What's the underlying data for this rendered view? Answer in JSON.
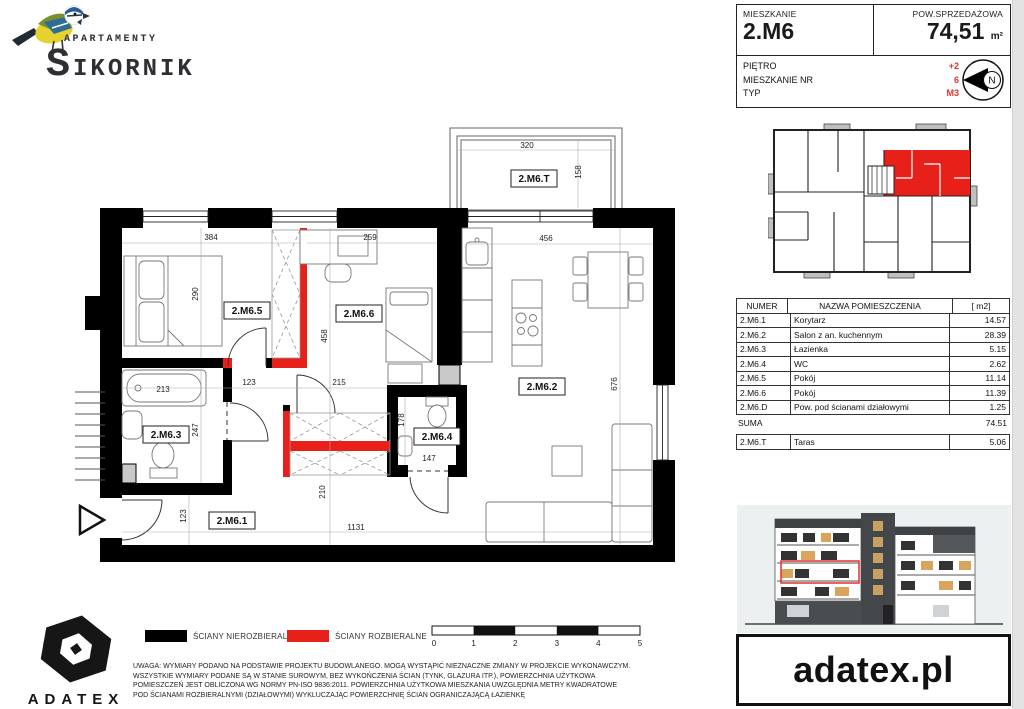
{
  "brand": {
    "apartamenty": "APARTAMENTY",
    "sikornik": "SIKORNIK",
    "adatex": "ADATEX",
    "website": "adatex.pl"
  },
  "info": {
    "mieszkanie_label": "MIESZKANIE",
    "mieszkanie_value": "2.M6",
    "pow_label": "POW.SPRZEDAŻOWA",
    "pow_value": "74,51",
    "pow_unit": "m²",
    "rows": [
      {
        "label": "PIĘTRO",
        "value": "+2"
      },
      {
        "label": "MIESZKANIE NR",
        "value": "6"
      },
      {
        "label": "TYP",
        "value": "M3"
      }
    ],
    "compass_n": "N",
    "accent_color": "#e03030"
  },
  "rooms_table": {
    "headers": [
      "NUMER",
      "NAZWA POMIESZCZENIA",
      "[ m2]"
    ],
    "rows": [
      {
        "num": "2.M6.1",
        "name": "Korytarz",
        "area": "14.57"
      },
      {
        "num": "2.M6.2",
        "name": "Salon z an. kuchennym",
        "area": "28.39"
      },
      {
        "num": "2.M6.3",
        "name": "Łazienka",
        "area": "5.15"
      },
      {
        "num": "2.M6.4",
        "name": "WC",
        "area": "2.62"
      },
      {
        "num": "2.M6.5",
        "name": "Pokój",
        "area": "11.14"
      },
      {
        "num": "2.M6.6",
        "name": "Pokój",
        "area": "11.39"
      },
      {
        "num": "2.M6.D",
        "name": "Pow. pod ścianami działowymi",
        "area": "1.25"
      }
    ],
    "suma_label": "SUMA",
    "suma_value": "74.51",
    "taras": {
      "num": "2.M6.T",
      "name": "Taras",
      "area": "5.06"
    }
  },
  "plan": {
    "labels": {
      "r1": "2.M6.1",
      "r2": "2.M6.2",
      "r3": "2.M6.3",
      "r4": "2.M6.4",
      "r5": "2.M6.5",
      "r6": "2.M6.6",
      "t": "2.M6.T"
    },
    "dims": {
      "terrace_w": "320",
      "terrace_h": "158",
      "w384": "384",
      "h290": "290",
      "w259": "259",
      "h458": "458",
      "w456": "456",
      "h676": "676",
      "tub213": "213",
      "w123": "123",
      "w215": "215",
      "h247": "247",
      "h178": "178",
      "w147": "147",
      "e123": "123",
      "h210": "210",
      "w1131": "1131"
    },
    "wall_black": "#000000",
    "wall_red": "#e8201a"
  },
  "legend": {
    "item1": "ŚCIANY NIEROZBIERALNE",
    "item2": "ŚCIANY ROZBIERALNE",
    "wall_black": "#000000",
    "wall_red": "#e8201a",
    "scale_ticks": [
      "0",
      "1",
      "2",
      "3",
      "4",
      "5"
    ]
  },
  "disclaimer": {
    "line1": "UWAGA:  WYMIARY PODANO NA PODSTAWIE PROJEKTU BUDOWLANEGO.  MOGĄ WYSTĄPIĆ NIEZNACZNE ZMIANY W PROJEKCIE WYKONAWCZYM.",
    "line2": "WSZYSTKIE WYMIARY PODANE SĄ W STANIE SUROWYM, BEZ WYKOŃCZENIA ŚCIAN (TYNK, GLAZURA ITP.), POWIERZCHNIA UŻYTKOWA",
    "line3": "POMIESZCZEŃ JEST OBLICZONA WG NORMY PN-ISO 9836:2011.  POWIERZCHNIA UŻYTKOWA MIESZKANIA UWZGLĘDNIA METRY KWADRATOWE",
    "line4": "POD ŚCIANAMI ROZBIERALNYMI (DZIAŁOWYMI) WYKLUCZAJĄC POWIERZCHNIĘ ŚCIAN OGRANICZAJĄCĄ ŁAZIENKĘ"
  }
}
